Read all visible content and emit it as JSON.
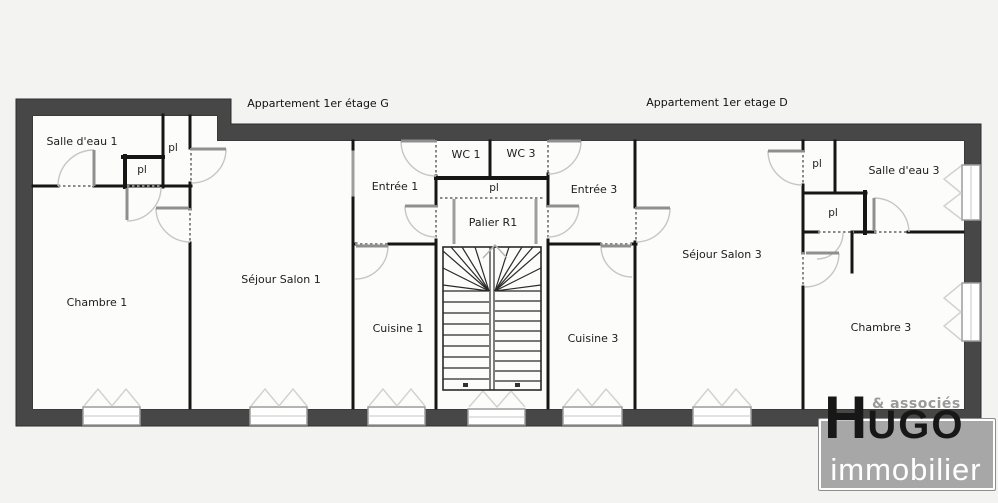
{
  "canvas": {
    "background": "#f3f3f1",
    "floor_color": "#fcfcfb",
    "wall_color": "#474747"
  },
  "floorplan": {
    "apartments": [
      {
        "label": "Appartement 1er étage G"
      },
      {
        "label": "Appartement 1er etage D"
      }
    ],
    "rooms": [
      {
        "label": "Salle d'eau 1"
      },
      {
        "label": "Chambre 1"
      },
      {
        "label": "Séjour Salon 1"
      },
      {
        "label": "Cuisine 1"
      },
      {
        "label": "Entrée 1"
      },
      {
        "label": "WC 1"
      },
      {
        "label": "Palier R1"
      },
      {
        "label": "WC 3"
      },
      {
        "label": "Entrée 3"
      },
      {
        "label": "Séjour Salon 3"
      },
      {
        "label": "Cuisine 3"
      },
      {
        "label": "Chambre 3"
      },
      {
        "label": "Salle d'eau 3"
      }
    ],
    "closets": [
      {
        "label": "pl"
      },
      {
        "label": "pl"
      },
      {
        "label": "pl"
      },
      {
        "label": "pl"
      },
      {
        "label": "pl"
      }
    ]
  },
  "logo": {
    "brand_initial": "H",
    "brand_rest": "UGO",
    "brand_sub": "immobilier",
    "brand_top": "& associés"
  }
}
